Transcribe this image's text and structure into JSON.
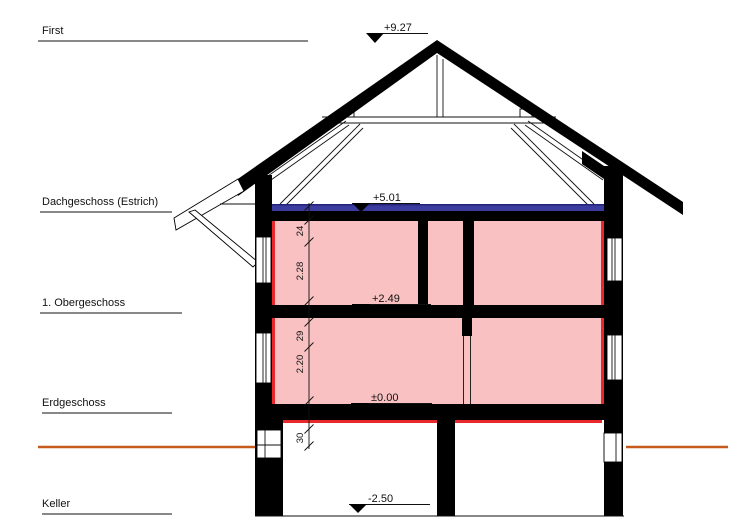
{
  "drawing": {
    "levels": [
      {
        "id": "first",
        "label": "First",
        "elevation": "+9.27"
      },
      {
        "id": "dachgeschoss",
        "label": "Dachgeschoss (Estrich)",
        "elevation": "+5.01"
      },
      {
        "id": "obergeschoss",
        "label": "1. Obergeschoss",
        "elevation": "+2.49"
      },
      {
        "id": "erdgeschoss",
        "label": "Erdgeschoss",
        "elevation": "±0.00"
      },
      {
        "id": "keller",
        "label": "Keller",
        "elevation": "-2.50"
      }
    ],
    "dim_chain": {
      "values": [
        "24",
        "2.28",
        "29",
        "2.20",
        "30"
      ]
    },
    "colors": {
      "wall_fill": "#f9c1c1",
      "accent_red": "#e8292c",
      "screed_blue": "#3c3b9e",
      "screed_blue_dark": "#24237c",
      "ground_orange": "#c75a1d"
    }
  }
}
